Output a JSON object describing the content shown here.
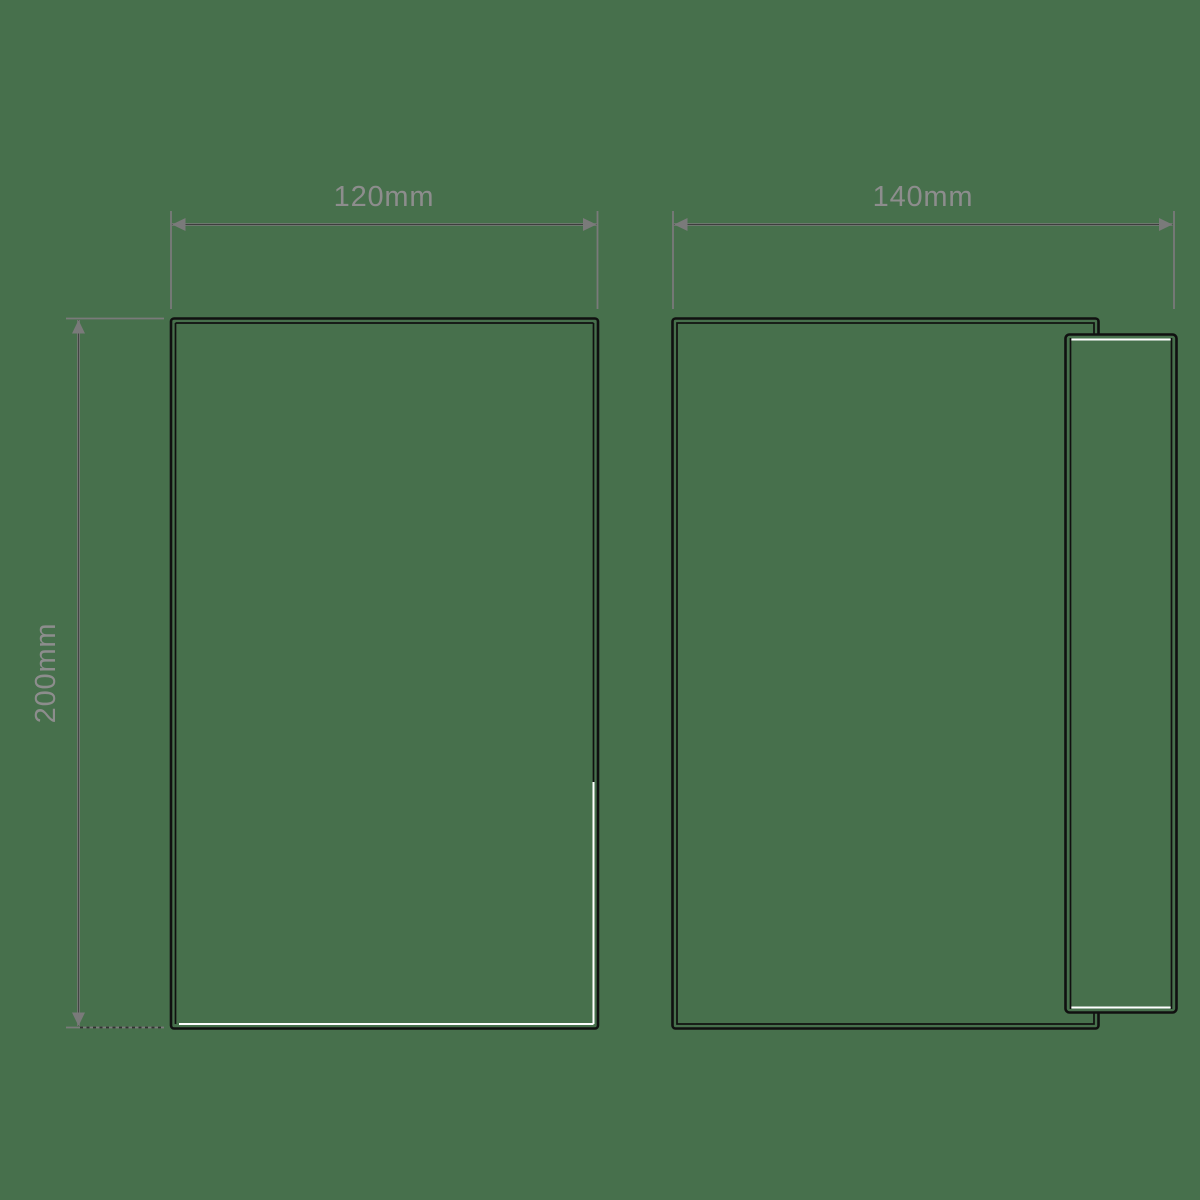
{
  "colors": {
    "background_color": "#47704C",
    "outline_color": "#101010",
    "dimension_color": "#7A7A7A",
    "label_color": "#8D8D8D",
    "highlight_color": "#FFFFFF"
  },
  "left_figure": {
    "width_label": "120mm",
    "height_label": "200mm"
  },
  "right_figure": {
    "width_label": "140mm"
  }
}
